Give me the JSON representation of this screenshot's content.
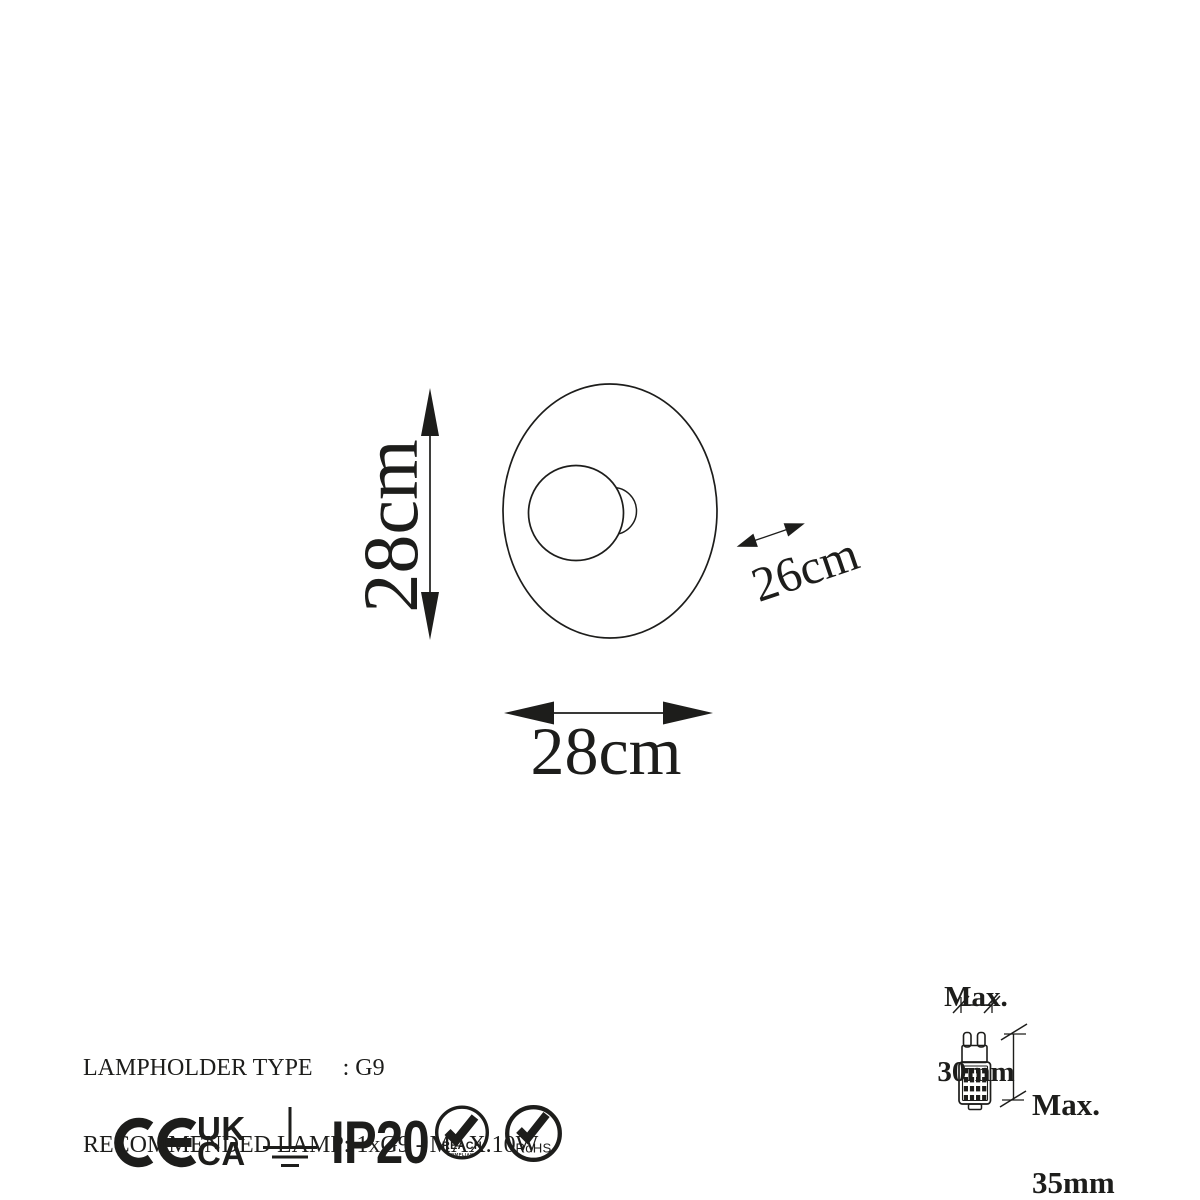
{
  "product_diagram": {
    "dim_height": "28cm",
    "dim_width": "28cm",
    "dim_depth": "26cm",
    "spec_line1": "LAMPHOLDER TYPE     : G9",
    "spec_line2": "RECOMMENDED LAMP: 1xG9 - MAX.10W",
    "bulb_max_width_line1": "Max.",
    "bulb_max_width_line2": "30mm",
    "bulb_max_height_line1": "Max.",
    "bulb_max_height_line2": "35mm",
    "cert_ukca_top": "UK",
    "cert_ukca_bottom": "CA",
    "cert_ip": "IP20",
    "badge_reach": "REACH",
    "badge_reach_sub": "COMPLIANT",
    "badge_rohs": "RoHS",
    "colors": {
      "ink": "#1d1d1b",
      "background": "#ffffff"
    }
  }
}
